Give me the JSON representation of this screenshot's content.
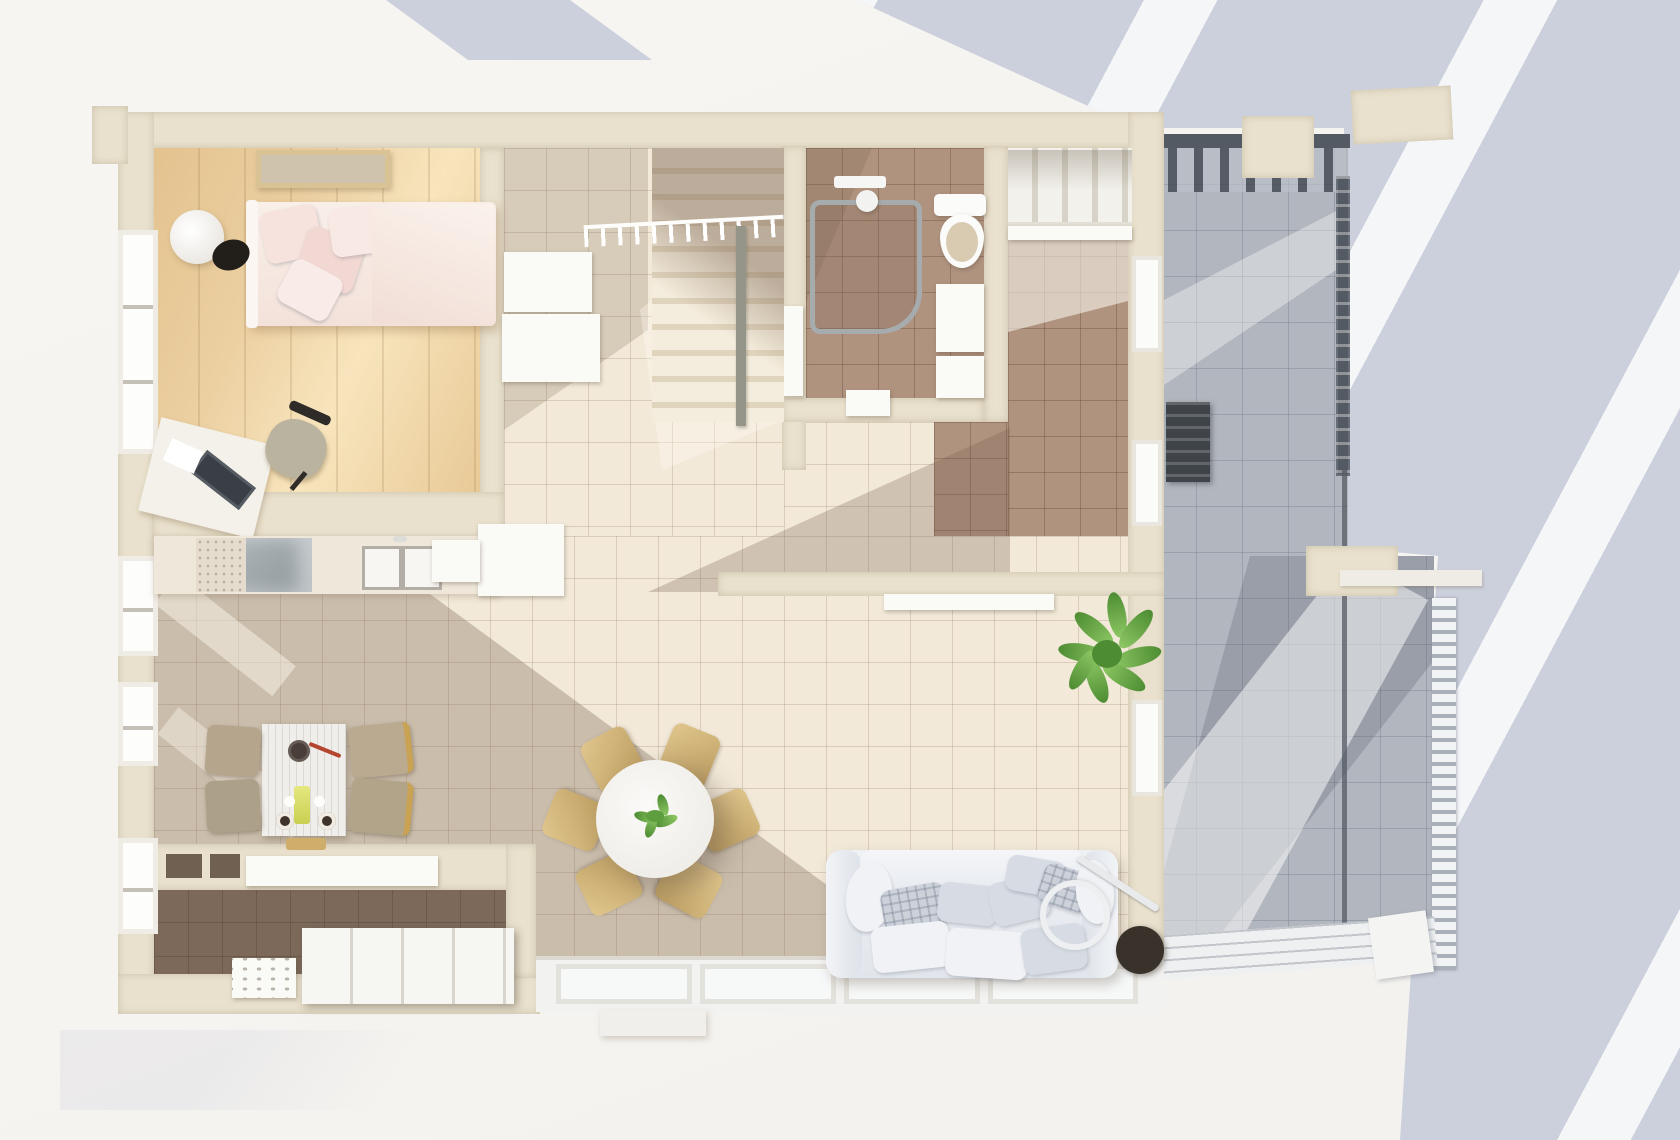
{
  "scene": {
    "type": "3d-floor-plan-top-down-render",
    "style": "architectural visualization, strong sunlight with diagonal shadows",
    "rooms": [
      {
        "id": "bedroom-upper-left",
        "floor": "light-wood-plank",
        "furniture": [
          "wall-art-frame",
          "double-bed-pink-bedding",
          "round-floor-lamp",
          "desk-with-laptop",
          "desk-chair"
        ]
      },
      {
        "id": "entry-hall",
        "floor": "cream-tile",
        "furniture": [
          "white-sideboard",
          "staircase",
          "stair-railing-with-balusters"
        ]
      },
      {
        "id": "bathroom",
        "floor": "brown-tile",
        "furniture": [
          "corner-shower",
          "toilet",
          "vanity-sink",
          "washer"
        ]
      },
      {
        "id": "closet-room-upper-right",
        "floor": "brown-tile",
        "furniture": [
          "wardrobe-open-shelving",
          "balcony-door"
        ]
      },
      {
        "id": "kitchen",
        "floor": "cream-tile",
        "furniture": [
          "counter-run",
          "marble-worktop",
          "glass-cooktop",
          "double-sink",
          "island-block"
        ]
      },
      {
        "id": "dining-nook",
        "floor": "cream-tile-shadowed",
        "furniture": [
          "rectangular-table",
          "tableware",
          "four-chairs"
        ]
      },
      {
        "id": "living-dining",
        "floor": "cream-tile",
        "furniture": [
          "round-dining-table",
          "centerpiece-plant",
          "six-tan-chairs",
          "large-sofa-with-cushions",
          "arc-ring-floor-lamp",
          "potted-plant"
        ]
      },
      {
        "id": "bedroom-lower-left",
        "floor": "dark-brown-tile",
        "furniture": [
          "platform-bed-white",
          "nightstand"
        ]
      },
      {
        "id": "balcony",
        "floor": "gray-tile",
        "furniture": [
          "pergola-beams",
          "dark-railing",
          "white-slat-railing",
          "ac-unit",
          "cream-beam"
        ]
      }
    ]
  },
  "colors": {
    "bg": "#f6f4f0",
    "blue": "#ccd0dc",
    "wall": "#e9e1cd",
    "wood": "#ecd0a2",
    "wood_light": "#f8e5bd",
    "tile_cream": "#f2e9d9",
    "tile_brown": "#b0937f",
    "tile_dark": "#7f6e60",
    "tile_gray": "#b2b7bf",
    "sofa": "#e7eaef",
    "pillow": "#d7dce4",
    "chair_tan": "#cfb277",
    "chair_beige": "#b5a58d",
    "table_white": "#f5f4f1",
    "plant": "#6fae48",
    "lamp_dark": "#39322b",
    "rail_dark": "#545a63",
    "fixture": "#fafaf7",
    "gold": "#c9a254",
    "bed_pink": "#f6e3de"
  }
}
